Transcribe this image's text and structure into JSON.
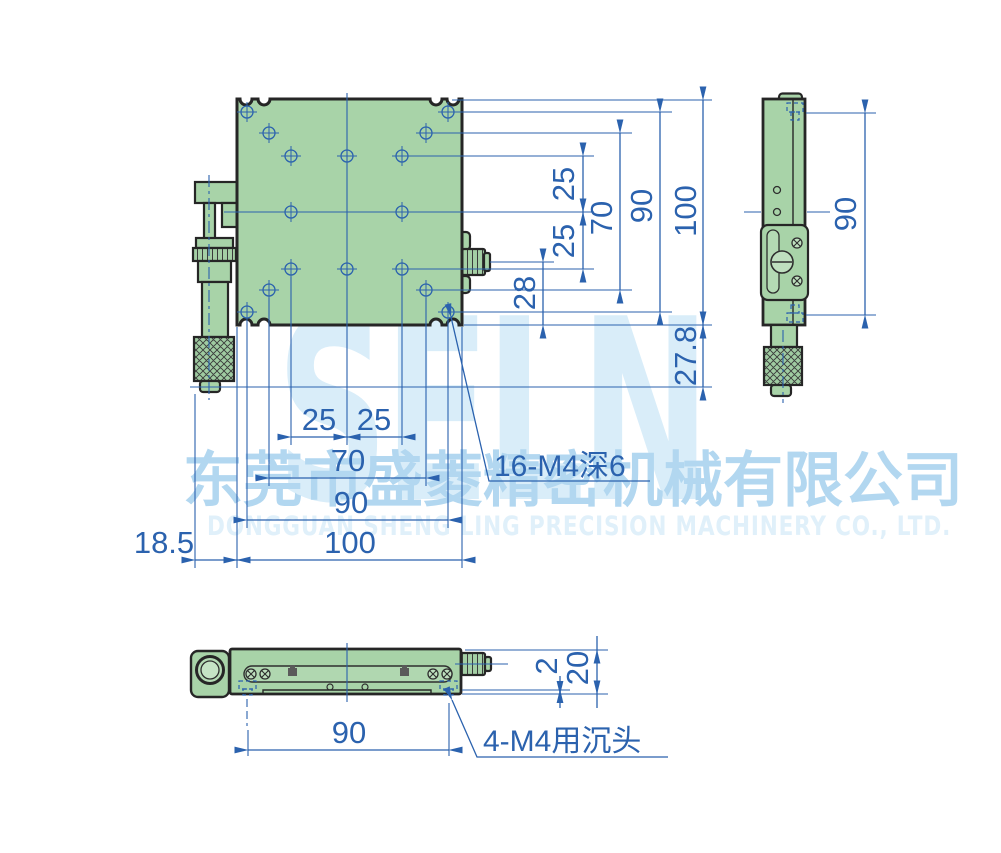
{
  "watermark": {
    "brand": "SELN",
    "company_cn": "东莞市盛菱精密机械有限公司",
    "company_en": "DONGGUAN SHENG LING PRECISION MACHINERY CO., LTD."
  },
  "colors": {
    "body_green": "#a8d3a8",
    "dim_blue": "#2b62ae",
    "outline_dark": "#262626",
    "watermark_light_blue": "#d9edf9",
    "watermark_mid_blue": "#b2d7f0"
  },
  "front_view": {
    "dim_row_top": "25",
    "dim_row_bottom": "25",
    "dim_row_span70": "70",
    "dim_row_span90": "90",
    "dim_height": "100",
    "dim_knob_axis": "28",
    "dim_micrometer_drop": "27.8",
    "dim_col_left": "25",
    "dim_col_right": "25",
    "dim_col_span70": "70",
    "dim_col_span90": "90",
    "dim_width": "100",
    "dim_overhang": "18.5",
    "callout_top_holes": "16-M4深6"
  },
  "side_view": {
    "dim_hole_span": "90"
  },
  "bottom_view": {
    "dim_hole_span": "90",
    "dim_recess": "2",
    "dim_height": "20",
    "callout_base_holes": "4-M4用沉头"
  }
}
